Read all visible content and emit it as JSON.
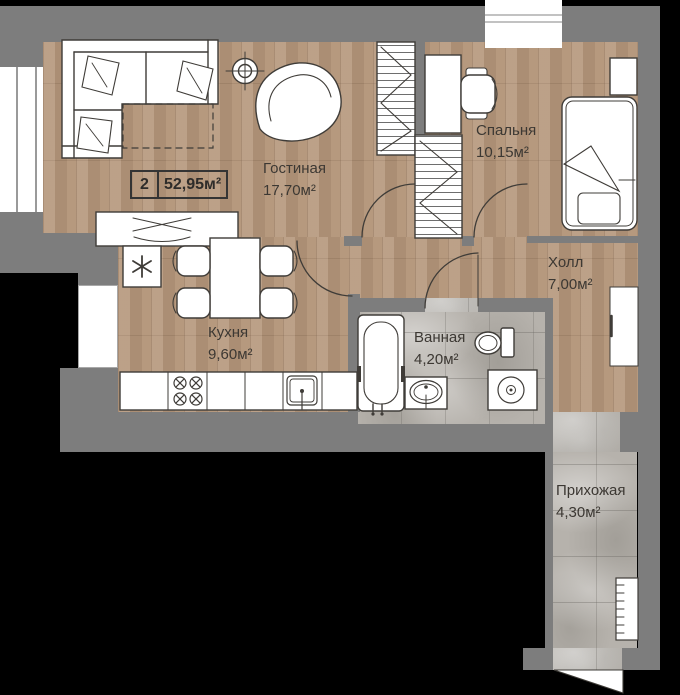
{
  "badge": {
    "rooms_count": "2",
    "total_area": "52,95м²"
  },
  "rooms": [
    {
      "name": "Гостиная",
      "area": "17,70м²"
    },
    {
      "name": "Спальня",
      "area": "10,15м²"
    },
    {
      "name": "Холл",
      "area": "7,00м²"
    },
    {
      "name": "Кухня",
      "area": "9,60м²"
    },
    {
      "name": "Ванная",
      "area": "4,20м²"
    },
    {
      "name": "Прихожая",
      "area": "4,30м²"
    }
  ],
  "colors": {
    "wall": "#7d7d7d",
    "wood_floor": "#b4967a",
    "stone_floor": "#b6b2ac",
    "furniture_outline": "#3f3c38",
    "label_text": "#3c3833",
    "background": "#000000"
  },
  "icons": [
    "sofa",
    "armchair",
    "ceiling-light",
    "tv-stand",
    "wardrobe-hangers",
    "desk",
    "desk-chair",
    "bed",
    "nightstand",
    "hall-closet",
    "fridge-snowflake",
    "dining-table",
    "chair",
    "stove-burners",
    "kitchen-sink",
    "bathtub",
    "washbasin",
    "toilet",
    "washing-machine",
    "shoe-rack",
    "door-swing",
    "window"
  ]
}
